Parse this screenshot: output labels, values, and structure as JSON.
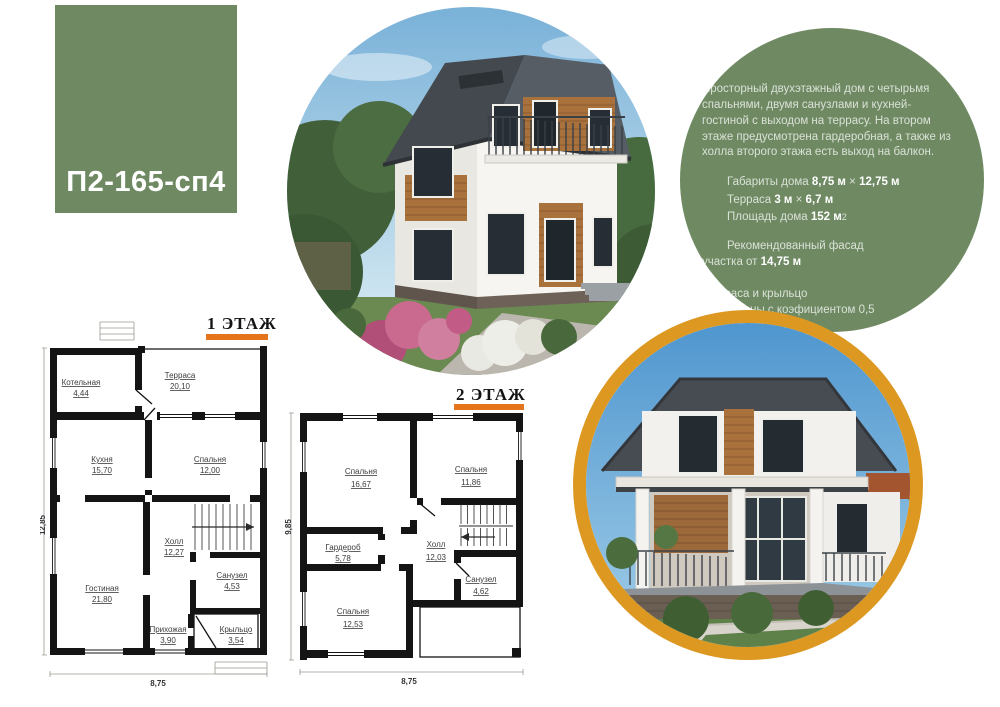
{
  "badge": {
    "code": "П2-165-сп4"
  },
  "colors": {
    "green": "#6f8a63",
    "orange_bar": "#e5751c",
    "orange_ring": "#dc9820"
  },
  "info": {
    "paragraph": "Просторный двухэтажный дом с четырьмя спальнями, двумя санузлами и кухней-гостиной с выходом на террасу. На втором этаже предусмотрена гардеробная, а также из холла второго этажа есть выход на балкон.",
    "dims_label": "Габариты дома",
    "dims_v1": "8,75 м",
    "dims_times": "×",
    "dims_v2": "12,75 м",
    "terrace_label": "Терраса",
    "terrace_v1": "3 м",
    "terrace_times": "×",
    "terrace_v2": "6,7 м",
    "area_label": "Площадь дома",
    "area_value": "152 м",
    "area_sup": "2",
    "facade_line1": "Рекомендованный фасад",
    "facade_line2": "участка от",
    "facade_value": "14,75 м",
    "footnote_line1": "*терраса и крыльцо",
    "footnote_line2": "рассчитаны с коэфициентом 0,5"
  },
  "plan1": {
    "title": "1 ЭТАЖ",
    "dim_left": "12,85",
    "dim_bottom": "8,75",
    "rooms": [
      {
        "name": "Котельная",
        "area": "4,44"
      },
      {
        "name": "Терраса",
        "area": "20,10"
      },
      {
        "name": "Кухня",
        "area": "15,70"
      },
      {
        "name": "Спальня",
        "area": "12,00"
      },
      {
        "name": "Холл",
        "area": "12,27"
      },
      {
        "name": "Гостиная",
        "area": "21,80"
      },
      {
        "name": "Санузел",
        "area": "4,53"
      },
      {
        "name": "Прихожая",
        "area": "3,90"
      },
      {
        "name": "Крыльцо",
        "area": "3,54"
      }
    ]
  },
  "plan2": {
    "title": "2 ЭТАЖ",
    "dim_left": "9,85",
    "dim_bottom": "8,75",
    "rooms": [
      {
        "name": "Спальня",
        "area": "16,67"
      },
      {
        "name": "Спальня",
        "area": "11,86"
      },
      {
        "name": "Гардероб",
        "area": "5,78"
      },
      {
        "name": "Холл",
        "area": "12,03"
      },
      {
        "name": "Санузел",
        "area": "4,62"
      },
      {
        "name": "Спальня",
        "area": "12,53"
      }
    ]
  }
}
